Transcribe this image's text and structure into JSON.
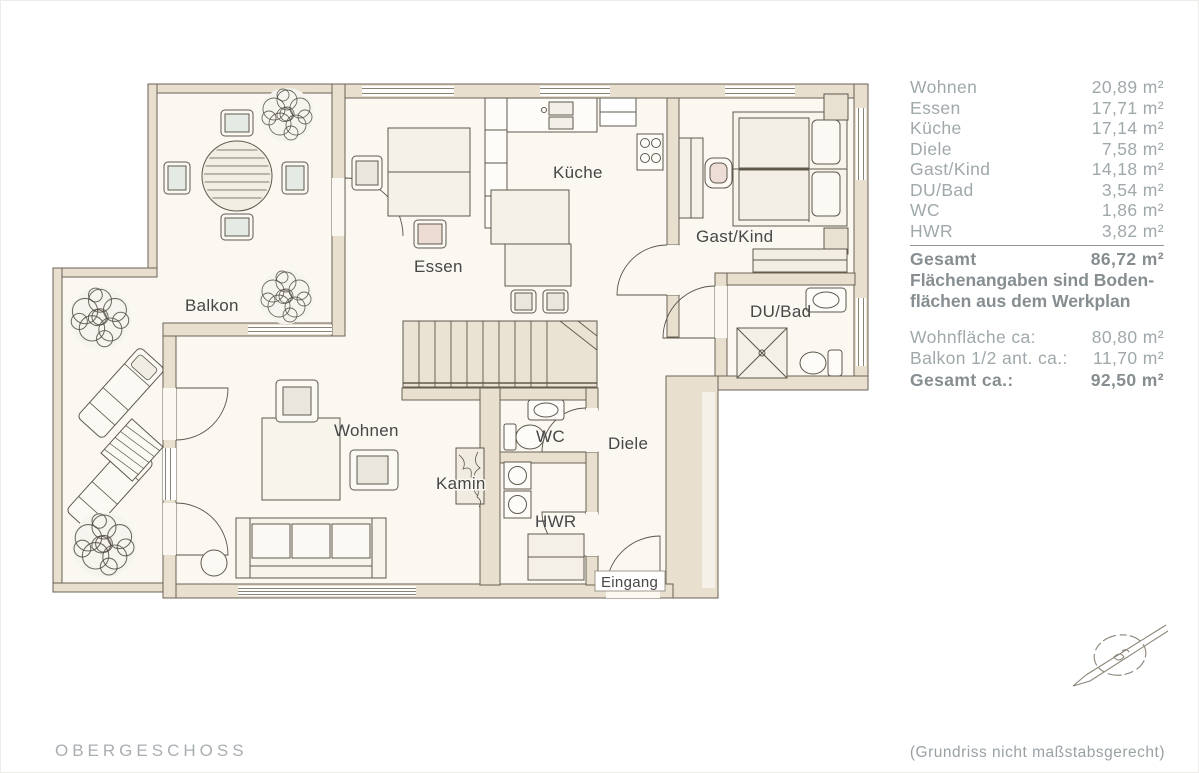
{
  "plan": {
    "rooms": {
      "balkon": "Balkon",
      "essen": "Essen",
      "kueche": "Küche",
      "gast_kind": "Gast/Kind",
      "du_bad": "DU/Bad",
      "wohnen": "Wohnen",
      "wc": "WC",
      "kamin": "Kamin",
      "hwr": "HWR",
      "diele": "Diele",
      "eingang": "Eingang"
    }
  },
  "area_table": {
    "rows": [
      {
        "label": "Wohnen",
        "value": "20,89 m²"
      },
      {
        "label": "Essen",
        "value": "17,71 m²"
      },
      {
        "label": "Küche",
        "value": "17,14 m²"
      },
      {
        "label": "Diele",
        "value": "7,58 m²"
      },
      {
        "label": "Gast/Kind",
        "value": "14,18 m²"
      },
      {
        "label": "DU/Bad",
        "value": "3,54 m²"
      },
      {
        "label": "WC",
        "value": "1,86 m²"
      },
      {
        "label": "HWR",
        "value": "3,82 m²"
      }
    ],
    "total": {
      "label": "Gesamt",
      "value": "86,72 m²"
    },
    "note_line1": "Flächenangaben sind Boden-",
    "note_line2": "flächen aus dem Werkplan",
    "summary": [
      {
        "label": "Wohnfläche ca:",
        "value": "80,80 m²"
      },
      {
        "label": "Balkon 1/2 ant. ca.:",
        "value": "11,70 m²"
      },
      {
        "label": "Gesamt ca.:",
        "value": "92,50 m²"
      }
    ]
  },
  "footer": {
    "floor_label": "OBERGESCHOSS",
    "scale_note": "(Grundriss nicht maßstabsgerecht)"
  },
  "colors": {
    "table_text": "#9fa8ab",
    "table_text_bold": "#868e91",
    "plan_ink": "#6b6254",
    "wall_fill": "#e8dfcf",
    "floor_fill": "#fbf8f2",
    "label_ink": "#474747"
  }
}
